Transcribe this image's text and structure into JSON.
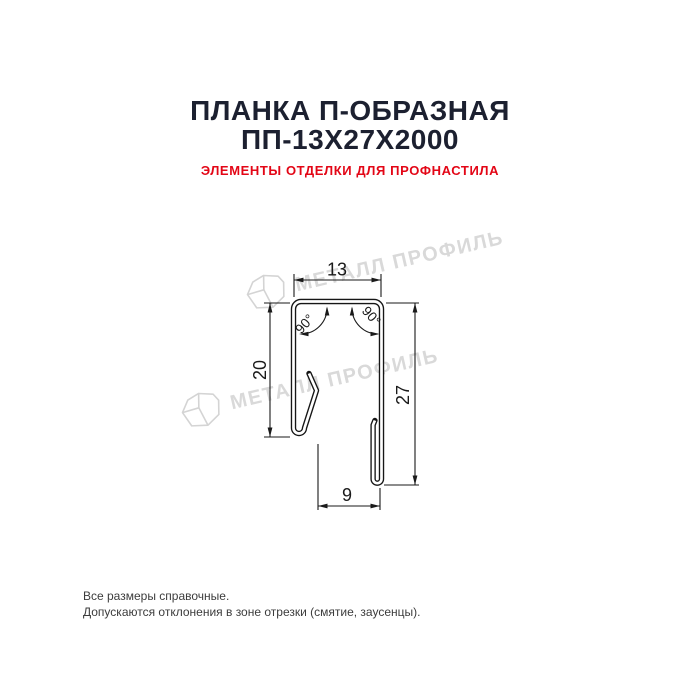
{
  "header": {
    "title_line1": "ПЛАНКА П-ОБРАЗНАЯ",
    "title_line2": "ПП-13Х27Х2000",
    "subtitle": "ЭЛЕМЕНТЫ ОТДЕЛКИ ДЛЯ ПРОФНАСТИЛА",
    "title_color": "#1c2030",
    "subtitle_color": "#e30616"
  },
  "drawing": {
    "type": "technical-profile-cross-section",
    "product": "П-образная планка (U-shaped strip)",
    "dimensions": {
      "top_width": "13",
      "left_height": "20",
      "right_height": "27",
      "bottom_width": "9",
      "angle_left": "90°",
      "angle_right": "90°"
    },
    "line_color": "#1a1a1a"
  },
  "watermark": {
    "text": "МЕТАЛЛ ПРОФИЛЬ",
    "color": "#d9d9d9"
  },
  "footer": {
    "line1": "Все размеры справочные.",
    "line2": "Допускаются отклонения в зоне отрезки (смятие, заусенцы).",
    "color": "#3c3c3c"
  }
}
